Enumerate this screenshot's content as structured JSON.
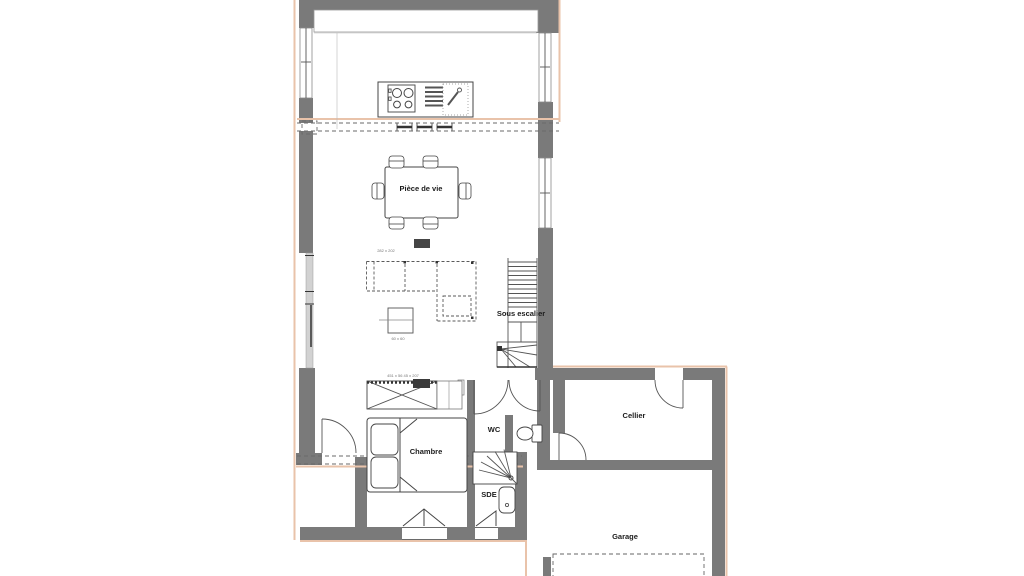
{
  "title": "Plan de maison - rez-de-chaussée",
  "colors": {
    "wall_gray": "#7a7a7a",
    "accent_peach": "#e9c3aa",
    "line_dark": "#444444",
    "furniture_line": "#555555",
    "glass_gray": "#d2d2d2",
    "dark_block": "#3f3f3f"
  },
  "rooms": {
    "living": {
      "label": "Pièce de vie"
    },
    "under_stairs": {
      "label": "Sous escalier"
    },
    "wc": {
      "label": "WC"
    },
    "bedroom": {
      "label": "Chambre"
    },
    "shower_room": {
      "label": "SDE"
    },
    "pantry": {
      "label": "Cellier"
    },
    "garage": {
      "label": "Garage"
    }
  },
  "annotations": {
    "wardrobe_dims": "451 x 56   45 x 207",
    "sofa_dims": "282 x 202",
    "coffee_table_dims": "60 x 60"
  }
}
